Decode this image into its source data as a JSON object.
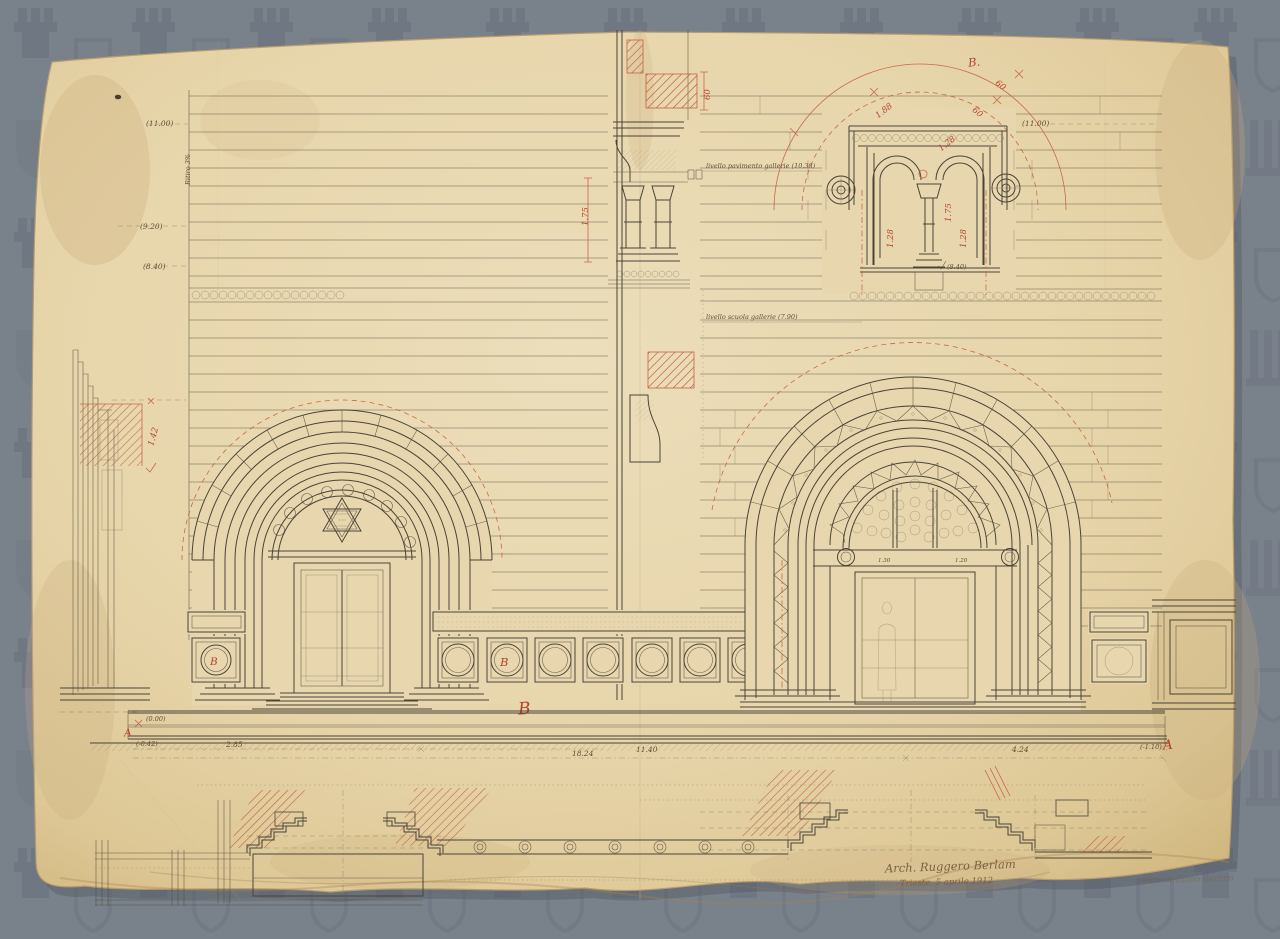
{
  "colors": {
    "background": "#79818b",
    "pattern_motif": "#6d7480",
    "paper": "#e8d7ae",
    "ink": "#4a4338",
    "red": "#b4452e",
    "pencil": "#8f8571"
  },
  "labels": {
    "left_levels": [
      "(11.00)",
      "(9.20)",
      "(8.40)"
    ],
    "ritiro": "Ritiro 3%",
    "right_level_top": "(11.00)",
    "bifora_level": "(8.40)",
    "level_zero": "(0.00)",
    "level_minus": "(-0.42)",
    "level_right_minus": "(-1.10)",
    "gallery_note": "livello pavimento gallerie (10.38)",
    "school_note": "livello scuola gallerie (7.90)"
  },
  "red_marks": {
    "detail_ref": "B.",
    "dim_arc": "1.88",
    "dim_angle_a": "60",
    "dim_angle_b": "60",
    "bay_left": "1.28",
    "bay_right": "1.28",
    "col_height": "1.75",
    "diag_dim": "1.28",
    "section_dim": "60",
    "section_col": "1.75",
    "jamb_dim": "1.42",
    "marker_a_left": "A",
    "marker_a_right": "A",
    "panel_b_left": "B",
    "panel_b_mid": "B",
    "ground_b": "B"
  },
  "dimensions": {
    "base": [
      "2.85",
      "18.24",
      "11.40",
      "4.24"
    ],
    "lintel_left": "1.30",
    "lintel_right": "1.20"
  },
  "signature": {
    "line1": "Arch. Ruggero Berlam",
    "line2": "Trieste, 5 aprile 1912",
    "line3": "Arch. Arduino Berlam"
  }
}
